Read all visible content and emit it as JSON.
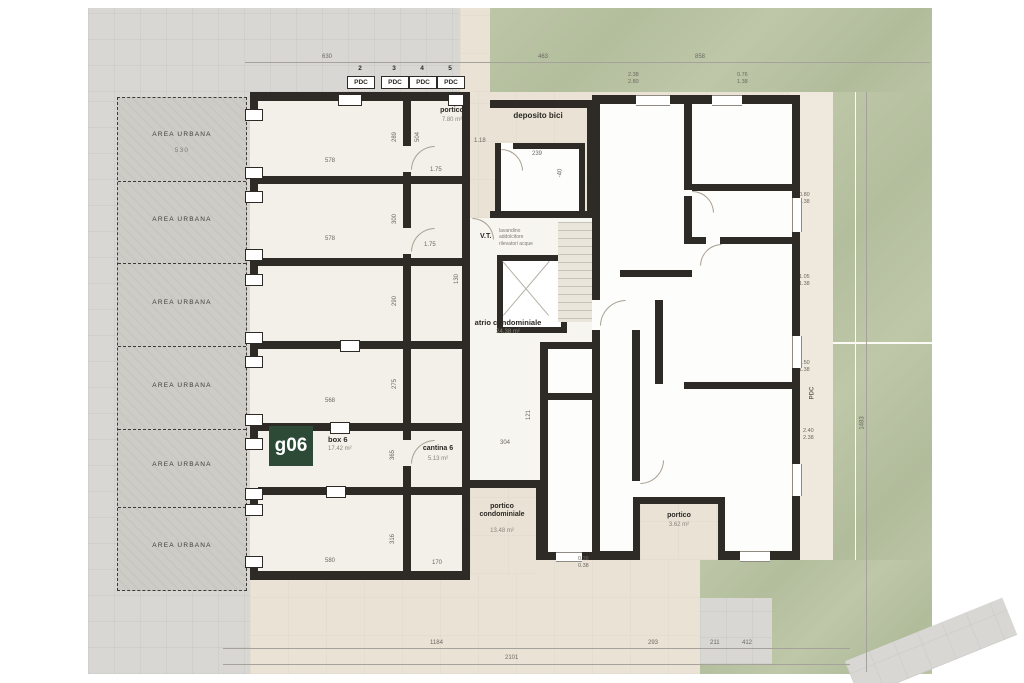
{
  "area_urbana": {
    "label": "AREA URBANA",
    "first_dim": "530",
    "left_pairs": [
      "2.50\n2.50",
      "2.40\n2.40",
      "2.40\n2.40",
      "2.45\n2.38",
      "2.45\n2.38",
      "2.30\n2.30"
    ]
  },
  "pdc": {
    "label": "PDC",
    "numbers": [
      "2",
      "3",
      "4",
      "5"
    ],
    "marker_one": "1",
    "right_vertical": "PDC"
  },
  "rooms": {
    "portico_top": {
      "name": "portico",
      "area": "7.80 m²"
    },
    "deposito_bici": {
      "name": "deposito bici",
      "dim": "239",
      "level": "-40"
    },
    "vt": {
      "name": "V.T.",
      "lines": "lavandino\naddolcitore\nrilevatori acque"
    },
    "atrio": {
      "name": "atrio condominiale",
      "area": "24.38 m²"
    },
    "box6": {
      "badge": "g06",
      "name": "box 6",
      "area": "17.42 m²"
    },
    "cantina6": {
      "name": "cantina 6",
      "area": "5.13 m²"
    },
    "portico_cond": {
      "name": "portico\ncondominiale",
      "area": "13.48 m²"
    },
    "portico_right": {
      "name": "portico",
      "area": "3.62 m²"
    }
  },
  "dims": {
    "top": [
      "630",
      "463",
      "858"
    ],
    "bottom": [
      "1184",
      "293",
      "211",
      "412"
    ],
    "bottom_total": "2101",
    "right_vertical": "1483",
    "right_pairs": [
      "0.80\n1.38",
      "1.05\n1.38",
      "0.50\n1.38",
      "2.40\n2.38"
    ],
    "top_pairs": [
      "2.38\n2.80",
      "0.76\n1.38"
    ],
    "box_widths": [
      "578",
      "578",
      "568",
      "580"
    ],
    "box_heights": [
      "289",
      "300",
      "290",
      "275",
      "365",
      "316"
    ],
    "misc": {
      "c504": "504",
      "d175a": "1.75",
      "d175b": "1.75",
      "d170": "170",
      "d118": "1.18",
      "d130": "130",
      "d304": "304",
      "d121": "121",
      "pair038": "0.38\n0.38"
    }
  }
}
